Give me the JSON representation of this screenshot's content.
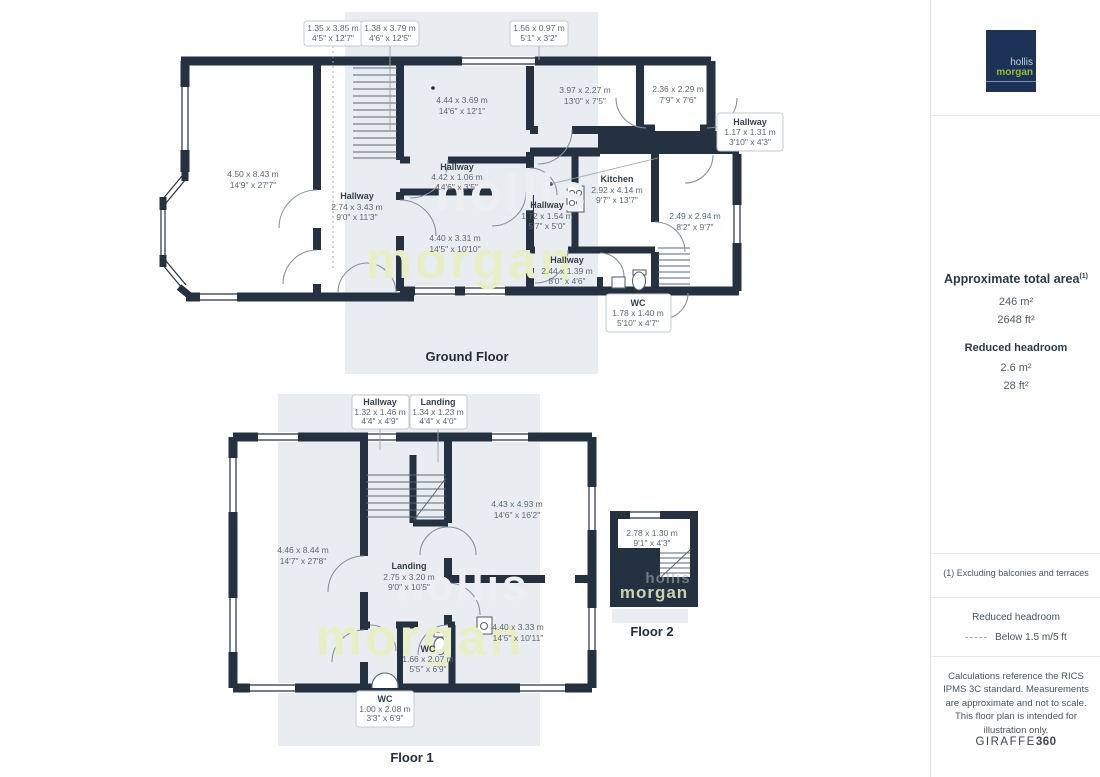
{
  "watermark": {
    "line1": "hollis",
    "line2": "morgan"
  },
  "logo": {
    "line1": "hollis",
    "line2": "morgan"
  },
  "ground_floor": {
    "label": "Ground Floor",
    "top_callouts": [
      {
        "metric": "1.35 x 3.85 m",
        "imperial": "4'5\" x 12'7\""
      },
      {
        "metric": "1.38 x 3.79 m",
        "imperial": "4'6\" x 12'5\""
      },
      {
        "metric": "1.56 x 0.97 m",
        "imperial": "5'1\" x 3'2\""
      }
    ],
    "rooms": [
      {
        "metric": "4.50 x 8.43 m",
        "imperial": "14'9\" x 27'7\""
      },
      {
        "metric": "4.44 x 3.69 m",
        "imperial": "14'6\" x 12'1\""
      },
      {
        "name": "Hallway",
        "metric": "4.42 x 1.06 m",
        "imperial": "14'6\" x 3'5\""
      },
      {
        "name": "Hallway",
        "metric": "2.74 x 3.43 m",
        "imperial": "9'0\" x 11'3\""
      },
      {
        "metric": "4.40 x 3.31 m",
        "imperial": "14'5\" x 10'10\""
      },
      {
        "metric": "3.97 x 2.27 m",
        "imperial": "13'0\" x 7'5\""
      },
      {
        "metric": "2.36 x 2.29 m",
        "imperial": "7'9\" x 7'6\""
      },
      {
        "name": "Kitchen",
        "metric": "2.92 x 4.14 m",
        "imperial": "9'7\" x 13'7\""
      },
      {
        "name": "Hallway",
        "metric": "1.72 x 1.54 m",
        "imperial": "5'7\" x 5'0\""
      },
      {
        "metric": "2.49 x 2.94 m",
        "imperial": "8'2\" x 9'7\""
      },
      {
        "name": "Hallway",
        "metric": "2.44 x 1.39 m",
        "imperial": "8'0\" x 4'6\""
      }
    ],
    "callouts": [
      {
        "name": "Hallway",
        "metric": "1.17 x 1.31 m",
        "imperial": "3'10\" x 4'3\""
      },
      {
        "name": "WC",
        "metric": "1.78 x 1.40 m",
        "imperial": "5'10\" x 4'7\""
      }
    ]
  },
  "floor1": {
    "label": "Floor 1",
    "top_callouts": [
      {
        "name": "Hallway",
        "metric": "1.32 x 1.46 m",
        "imperial": "4'4\" x 4'9\""
      },
      {
        "name": "Landing",
        "metric": "1.34 x 1.23 m",
        "imperial": "4'4\" x 4'0\""
      }
    ],
    "rooms": [
      {
        "metric": "4.46 x 8.44 m",
        "imperial": "14'7\" x 27'8\""
      },
      {
        "metric": "4.43 x 4.93 m",
        "imperial": "14'6\" x 16'2\""
      },
      {
        "name": "Landing",
        "metric": "2.75 x 3.20 m",
        "imperial": "9'0\" x 10'5\""
      },
      {
        "metric": "4.40 x 3.33 m",
        "imperial": "14'5\" x 10'11\""
      },
      {
        "name": "WC",
        "metric": "1.66 x 2.07 m",
        "imperial": "5'5\" x 6'9\""
      }
    ],
    "callouts": [
      {
        "name": "WC",
        "metric": "1.00 x 2.08 m",
        "imperial": "3'3\" x 6'9\""
      }
    ]
  },
  "floor2": {
    "label": "Floor 2",
    "rooms": [
      {
        "metric": "2.78 x 1.30 m",
        "imperial": "9'1\" x 4'3\""
      }
    ]
  },
  "sidebar": {
    "area_title": "Approximate total area",
    "area_title_sup": "(1)",
    "area_m2": "246 m²",
    "area_ft2": "2648 ft²",
    "reduced_title": "Reduced headroom",
    "reduced_m2": "2.6 m²",
    "reduced_ft2": "28 ft²",
    "note": "(1) Excluding balconies and terraces",
    "legend_title": "Reduced headroom",
    "legend_value": "Below 1.5 m/5 ft",
    "disclaimer": "Calculations reference the RICS IPMS 3C standard. Measurements are approximate and not to scale. This floor plan is intended for illustration only.",
    "brand_name": "GIRAFFE",
    "brand_suffix": "360"
  }
}
